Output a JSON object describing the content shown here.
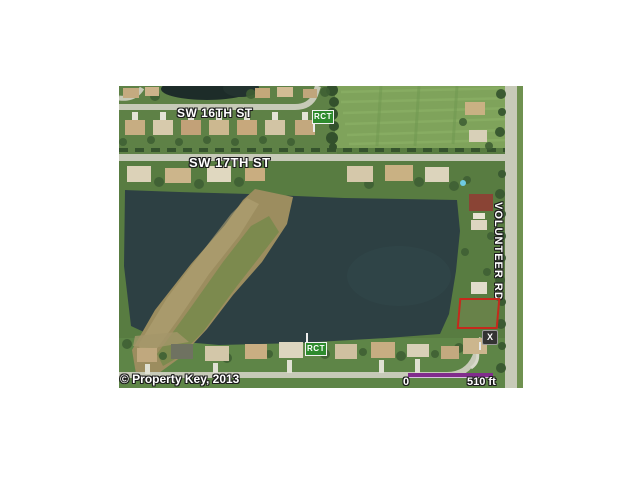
{
  "window": {
    "background": "#ffffff"
  },
  "map": {
    "street_labels": [
      {
        "id": "sw16",
        "text": "SW 16TH ST"
      },
      {
        "id": "sw17",
        "text": "SW 17TH ST"
      },
      {
        "id": "volunteer",
        "text": "VOLUNTEER RD"
      }
    ],
    "signs": {
      "top": "RCT",
      "bottom": "RCT"
    },
    "x_marker": "X",
    "scale_bar": {
      "start_label": "0",
      "end_label": "510 ft",
      "color": "#812d8c"
    },
    "copyright": "© Property Key, 2013",
    "colors": {
      "water": "#2d4043",
      "land": "#587c41",
      "field": "#7fa35b",
      "road": "#c7cab8",
      "peninsula": "#9c8d5f",
      "parcel_outline": "#c5291c",
      "sign_green": "#2e8b2e",
      "scale_bar": "#812d8c"
    }
  }
}
